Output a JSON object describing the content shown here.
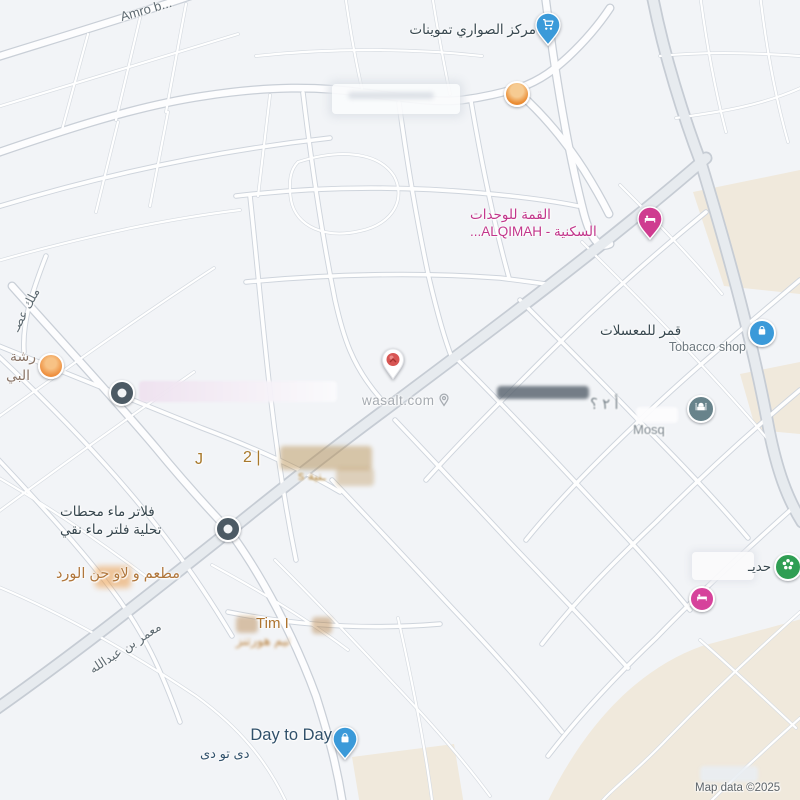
{
  "map": {
    "watermark": {
      "text": "wasalt.com"
    },
    "attribution": "Map data ©2025",
    "colors": {
      "background": "#f2f4f7",
      "commercial_area": "#f0e9dc",
      "road_casing": "#ced4dc",
      "highway_fill": "#e7ebef",
      "blue_marker": "#3b9ad9",
      "pink_marker": "#cf3b90",
      "green_marker": "#2f9e53",
      "orange_marker": "#ef9a3e",
      "slate_marker": "#4c5a64",
      "mosque_marker": "#68838b"
    },
    "streets": {
      "amro": "Amro b...",
      "muammar": "معمر بن عبدالله",
      "malik": "ملك عصـ"
    },
    "pois": {
      "grocery": {
        "label": "مركز الصواري تموينات",
        "marker_color": "#3b9ad9",
        "icon": "shopping-cart"
      },
      "alqimah": {
        "line1": "القمة للوحدات",
        "line2": "السكنية - ALQIMAH...",
        "marker_color": "#cf3b90",
        "icon": "bed"
      },
      "tobacco": {
        "line1": "قمر للمعسلات",
        "line2": "Tobacco shop",
        "marker_color": "#3b9ad9",
        "icon": "shopping-bag"
      },
      "workshop": {
        "line1": "رشة",
        "line2": "البي",
        "marker_color": "#ef9242"
      },
      "district": {
        "frag_j": "J",
        "frag_2": "2 |",
        "frag_line2": "ـنية s"
      },
      "mosque": {
        "label": "Mosq",
        "frag": "أ ٢ ؟",
        "marker_color": "#68838b",
        "icon": "mosque"
      },
      "water_filters": {
        "line1": "فلاتر ماء محطات",
        "line2": "تحلية فلتر ماء نقي",
        "marker_color": "#4c5a64"
      },
      "restaurant": {
        "label": "مطعم و لاو حن الورد"
      },
      "tim": {
        "line1": "Tim I",
        "line2": "تيم هورتنز"
      },
      "day_to_day": {
        "line1": "Day to Day",
        "line2": "دى تو دى",
        "marker_color": "#3b9ad9",
        "icon": "shopping-bag"
      },
      "park": {
        "label": "حديـ",
        "marker_color": "#2f9e53",
        "icon": "flower"
      }
    }
  }
}
